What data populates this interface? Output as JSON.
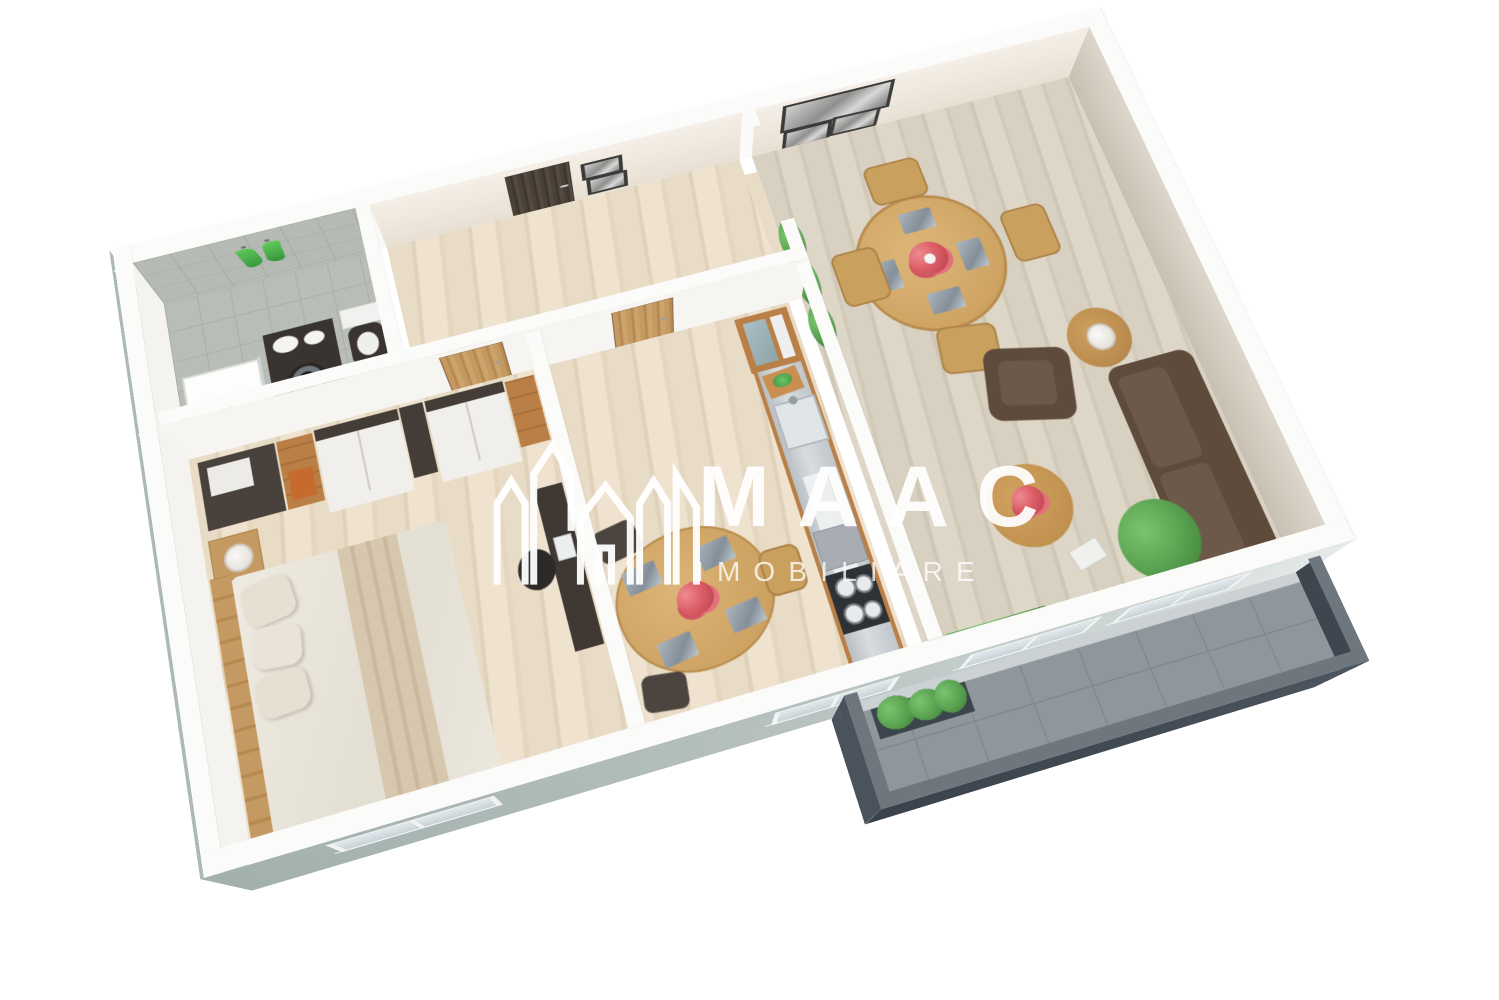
{
  "watermark": {
    "brand": "MAAC",
    "subtitle": "IMOBILIARE",
    "logo": "maac-house-logo"
  },
  "colors": {
    "background": "#ffffff",
    "wall_top": "#fbfbfa",
    "wall_face_interior": "#efe8de",
    "exterior_face": "#b2bfbd",
    "exterior_face_dark": "#9dabaa",
    "wood_floor": "#e9dcc6",
    "living_floor": "#d8d0c0",
    "tile_floor": "#b9bdb7",
    "balcony_floor": "#8f969c",
    "parapet": "#434c55",
    "parapet_dark": "#3e4750",
    "sofa_brown": "#5f4b3c",
    "wood_furniture": "#c9a05e",
    "cabinet_wood": "#b97f46",
    "door_dark": "#4a4139",
    "door_wood": "#c59a62",
    "steel": "#c6ccd0",
    "stove": "#2e3237",
    "towel_green": "#46b34e",
    "flower_red": "#dd5f68",
    "plant_green": "#58a04f",
    "lamp_white": "#f2f1ed",
    "watermark": "#ffffff"
  },
  "floorplan": {
    "type": "3d-rendered-floor-plan",
    "view": "isometric top-down, rotated, white walls, one-bedroom apartment with balcony",
    "rooms": [
      {
        "name": "bathroom",
        "position": "top-left",
        "floor": "grey-tile",
        "contents": [
          "shower-tray",
          "dark-vanity-with-two-sinks",
          "washing-machine",
          "toilet",
          "two-green-towels-on-tiled-wall"
        ]
      },
      {
        "name": "hallway",
        "position": "top-center",
        "floor": "light-wood",
        "contents": [
          "dark-entry-door",
          "two-small-picture-frames"
        ]
      },
      {
        "name": "bedroom",
        "position": "bottom-left",
        "floor": "light-wood",
        "contents": [
          "double-bed-with-white-bedding",
          "pillows",
          "wood-headboard",
          "nightstand-with-lamp",
          "white-and-dark-wardrobes",
          "orange-accent-shelf",
          "desk-with-chair"
        ]
      },
      {
        "name": "kitchen",
        "position": "center",
        "floor": "light-wood",
        "contents": [
          "wood-interior-door",
          "tall-cabinet",
          "stainless-counter-run",
          "sink",
          "gas-hob",
          "cutting-board-with-greens",
          "dining-table-with-flowers",
          "placemats",
          "chairs"
        ]
      },
      {
        "name": "living-room",
        "position": "right",
        "floor": "light-wood",
        "contents": [
          "round-dining-table",
          "four-wood-chairs",
          "flower-centerpiece",
          "three-picture-frames-on-wall",
          "brown-armchair",
          "brown-sofa",
          "round-side-table-with-lamp",
          "two-round-coffee-tables",
          "book",
          "potted-plants"
        ]
      },
      {
        "name": "balcony",
        "position": "bottom-right",
        "floor": "grey-tile",
        "contents": [
          "dark-parapet-walls",
          "planter-with-greenery",
          "white-threshold"
        ]
      }
    ],
    "windows": [
      "bedroom-south-window",
      "kitchen-south-window",
      "living-room-south-window-1",
      "living-room-south-window-2"
    ]
  }
}
